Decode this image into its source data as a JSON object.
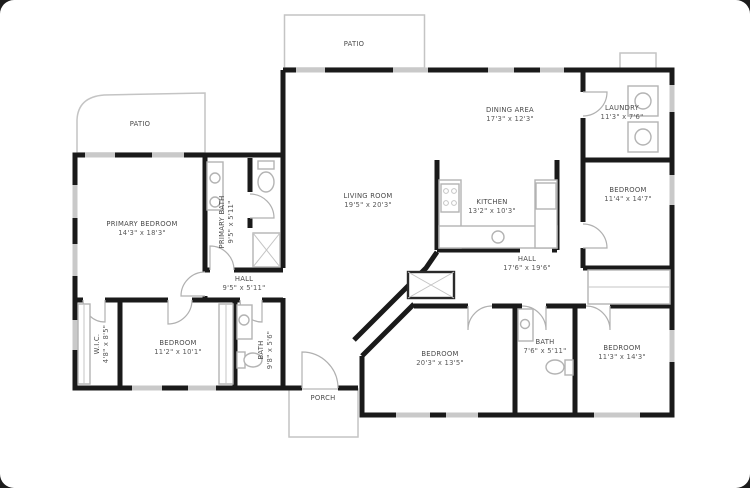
{
  "plan_title": "Floor Plan",
  "colors": {
    "wall": "#1a1a1a",
    "window": "#c9c9c9",
    "door": "#b0b0b0",
    "fixture": "#b3b3b3",
    "label_text": "#4a4a4a",
    "background": "#ffffff",
    "frame": "#1c1c1c"
  },
  "rooms": {
    "patio_top": {
      "label": "PATIO",
      "dims": ""
    },
    "patio_left": {
      "label": "PATIO",
      "dims": ""
    },
    "laundry": {
      "label": "LAUNDRY",
      "dims": "11'3\" x 7'6\""
    },
    "dining": {
      "label": "DINING AREA",
      "dims": "17'3\" x 12'3\""
    },
    "living": {
      "label": "LIVING ROOM",
      "dims": "19'5\" x 20'3\""
    },
    "kitchen": {
      "label": "KITCHEN",
      "dims": "13'2\" x 10'3\""
    },
    "bedroom_ne": {
      "label": "BEDROOM",
      "dims": "11'4\" x 14'7\""
    },
    "primary_bedroom": {
      "label": "PRIMARY BEDROOM",
      "dims": "14'3\" x 18'3\""
    },
    "primary_bath": {
      "label": "PRIMARY BATH",
      "dims": "9'5\" x 5'11\""
    },
    "hall_west": {
      "label": "HALL",
      "dims": "9'5\" x 5'11\""
    },
    "hall_east": {
      "label": "HALL",
      "dims": "17'6\" x 19'6\""
    },
    "wic": {
      "label": "W.I.C.",
      "dims": "4'8\" x 8'5\""
    },
    "bedroom_sw": {
      "label": "BEDROOM",
      "dims": "11'2\" x 10'1\""
    },
    "bath_mid": {
      "label": "BATH",
      "dims": "9'8\" x 5'6\""
    },
    "bedroom_s": {
      "label": "BEDROOM",
      "dims": "20'3\" x 13'5\""
    },
    "bath_east": {
      "label": "BATH",
      "dims": "7'6\" x 5'11\""
    },
    "bedroom_se": {
      "label": "BEDROOM",
      "dims": "11'3\" x 14'3\""
    },
    "porch": {
      "label": "PORCH",
      "dims": ""
    }
  }
}
